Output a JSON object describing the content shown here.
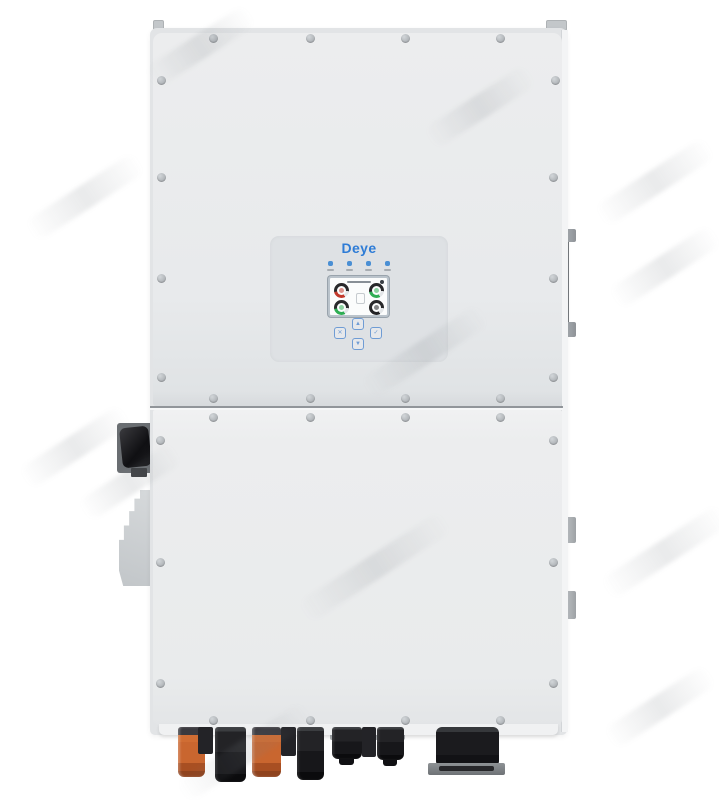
{
  "inverter": {
    "brand": "Deye",
    "colors": {
      "brand_blue": "#2e7cd6",
      "body": "#e8eaec",
      "body_lower": "#ebedee",
      "panel": "#dee1e4",
      "seam": "#767b80",
      "screw": "#aeb2b6",
      "led_blue": "#4a8fd4",
      "button_blue": "#6f9cd4",
      "gauge_red": "#c2392c",
      "gauge_green": "#2fae54",
      "gauge_dark": "#29292b",
      "orange_connector": "#c9662f",
      "black_connector": "#17171a",
      "metal_gray": "#9da2a6"
    },
    "display": {
      "leds": [
        {
          "id": "led-1"
        },
        {
          "id": "led-2"
        },
        {
          "id": "led-3"
        },
        {
          "id": "led-4"
        }
      ],
      "gauges": [
        {
          "id": "gauge-top-left",
          "arc_color": "#c2392c"
        },
        {
          "id": "gauge-top-right",
          "arc_color": "#2fae54"
        },
        {
          "id": "gauge-bottom-left",
          "arc_color": "#2fae54"
        },
        {
          "id": "gauge-bottom-right",
          "arc_color": "#232325"
        }
      ]
    },
    "nav_buttons": [
      {
        "id": "up",
        "glyph": "▲"
      },
      {
        "id": "esc",
        "glyph": "✕"
      },
      {
        "id": "enter",
        "glyph": "✓"
      },
      {
        "id": "down",
        "glyph": "▼"
      }
    ],
    "connectors": {
      "battery_terminals": [
        "orange",
        "black",
        "orange",
        "black"
      ],
      "pv_terminals": [
        "black",
        "black",
        "black"
      ],
      "ac_gland": "black"
    }
  }
}
